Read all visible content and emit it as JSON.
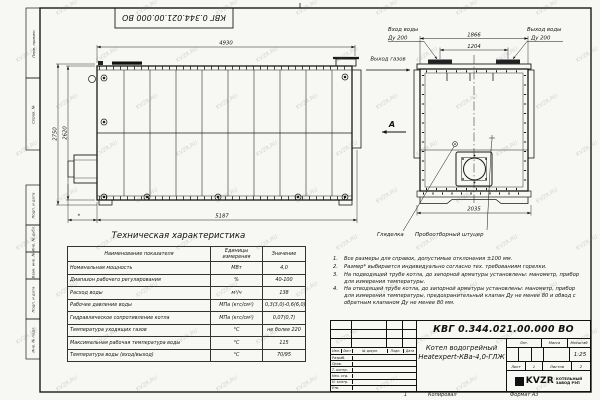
{
  "watermark": {
    "text": "KVZR.RU"
  },
  "frame": {
    "top_stamp": "КВГ 0.344.021.00.000 ВО",
    "margin_boxes": [
      {
        "label": "Перв. примен."
      },
      {
        "label": "Справ. №"
      },
      {
        "label": "Подп. и дата"
      },
      {
        "label": "Инв. № дубл."
      },
      {
        "label": "Взам. инв. №"
      },
      {
        "label": "Подп. и дата"
      },
      {
        "label": "Инв. № подл."
      }
    ],
    "zone": "1",
    "copied": "Копировал",
    "format": "Формат А3"
  },
  "views": {
    "side": {
      "dim_length_top": "4930",
      "dim_height_outer": "2750",
      "dim_height_inner": "2620",
      "dim_length_bottom": "5187",
      "dim_burner": "*",
      "gas_out_label": "Выход газов",
      "view_arrow_label": "А"
    },
    "front": {
      "dim_width_flanges": "1866",
      "dim_nozzle_spacing": "1204",
      "dim_base_width": "2035",
      "water_in": "Вход воды",
      "water_in_dn": "Ду 200",
      "water_out": "Выход воды",
      "water_out_dn": "Ду 200",
      "peephole": "Гляделка",
      "sampling": "Пробоотборный штуцер"
    }
  },
  "spec_table": {
    "title": "Техническая характеристика",
    "col_name": "Наименование показателя",
    "col_units": "Единицы измерения",
    "col_value": "Значение",
    "rows": [
      [
        "Номинальная мощность",
        "МВт",
        "4,0"
      ],
      [
        "Диапазон рабочего регулирования",
        "%",
        "40-100"
      ],
      [
        "Расход воды",
        "м³/ч",
        "138"
      ],
      [
        "Рабочее давление воды",
        "МПа (кгс/см²)",
        "0,3(3,0)-0,6(6,0)"
      ],
      [
        "Гидравлическое сопротивление котла",
        "МПа (кгс/см²)",
        "0,07(0,7)"
      ],
      [
        "Температура уходящих газов",
        "°С",
        "не более 220"
      ],
      [
        "Максимальная рабочая температура воды",
        "°С",
        "115"
      ],
      [
        "Температура воды (вход/выход)",
        "°С",
        "70/95"
      ]
    ]
  },
  "notes": [
    {
      "n": "1.",
      "text": "Все размеры для справок, допустимые отклонения ±100 мм."
    },
    {
      "n": "2.",
      "text": "Размер* выбирается индивидуально согласно тех. требованиям горелки."
    },
    {
      "n": "3.",
      "text": "На подводящей трубе котла, до запорной арматуры установлены: манометр, прибор для измерения температуры."
    },
    {
      "n": "4.",
      "text": "На отводящей трубе котла, до запорной арматуры установлены: манометр, прибор для измерения температуры, предохранительный клапан Ду не менее 80 и обвод с обратным клапаном Ду не менее 80 мм."
    }
  ],
  "title_block": {
    "doc_number": "КВГ 0.344.021.00.000 ВО",
    "product_line1": "Котел водогрейный",
    "product_line2": "Heatexpert-КВа-4,0-ГЛЖ",
    "lit_label": "Лит.",
    "mass_label": "Масса",
    "scale_label": "Масштаб",
    "scale_value": "1:25",
    "sheet_label": "Лист",
    "sheet_value": "1",
    "sheets_label": "Листов",
    "sheets_value": "2",
    "sig_header": [
      "Изм.",
      "Лист",
      "№ докум.",
      "Подп.",
      "Дата"
    ],
    "sig_rows": [
      "Разраб.",
      "Пров.",
      "Т. контр.",
      "Нач. отд.",
      "Н. контр.",
      "Утв."
    ],
    "logo_text": "KVZR",
    "logo_sub1": "КОТЕЛЬНЫЙ",
    "logo_sub2": "ЗАВОД РЭП"
  }
}
